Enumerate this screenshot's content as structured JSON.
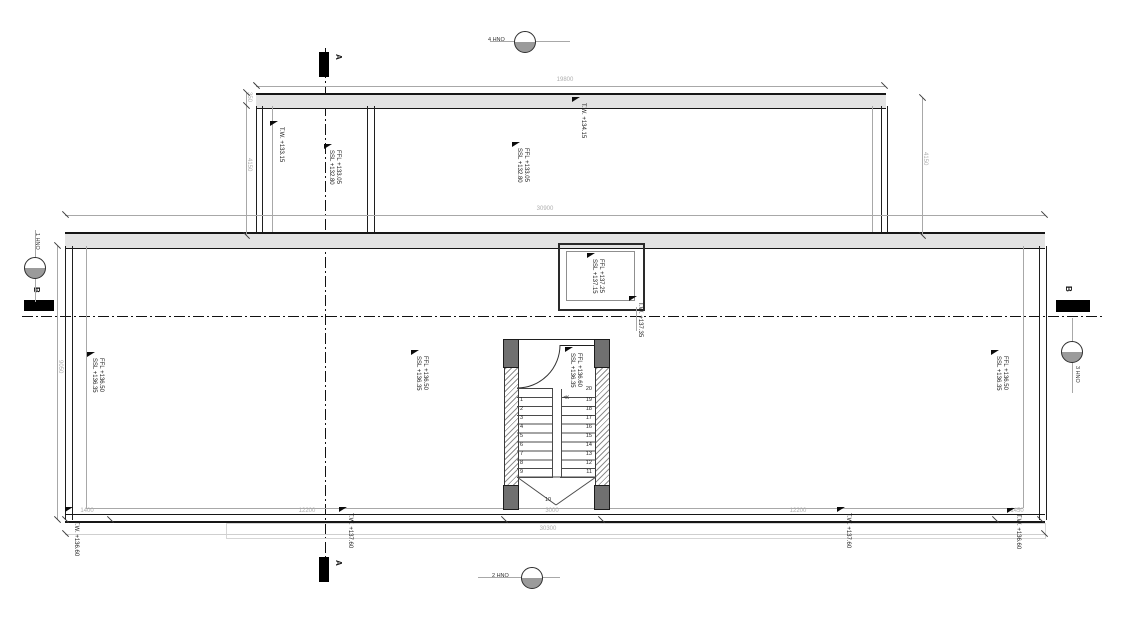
{
  "sections": {
    "a_label": "A",
    "b_label": "B"
  },
  "grid_markers": {
    "top": "4 HNO",
    "bottom": "2 HNO",
    "left": "1 HNO",
    "right": "3 HNO"
  },
  "dimensions": {
    "top_width": "19800",
    "mid_width": "30900",
    "bottom_total": "30300",
    "bottom_segments": [
      "1400",
      "12200",
      "3000",
      "12200",
      "1450"
    ],
    "upper_left_small": "350",
    "upper_left": "4150",
    "upper_right": "4150",
    "main_left": "9050"
  },
  "levels": {
    "upper_parapet_left": "T.W. +133.15",
    "upper_parapet_mid": "T.W. +134.15",
    "upper_ffl": "FFL +133.05",
    "upper_ssl": "SSL +132.80",
    "skylight_ffl": "FFL +137.25",
    "skylight_ssl": "SSL +137.15",
    "skylight_parapet": "T.W. +137.35",
    "main_ffl": "FFL +136.50",
    "main_ssl": "SSL +136.35",
    "stair_ffl": "FFL +136.60",
    "stair_ssl": "SSL +136.35",
    "parapet_corner": "T.W. +136.60",
    "parapet_inner": "T.W. +137.60"
  },
  "stair": {
    "numbers_left": [
      "1",
      "2",
      "3",
      "4",
      "5",
      "6",
      "7",
      "8",
      "9"
    ],
    "numbers_right": [
      "19",
      "18",
      "17",
      "16",
      "15",
      "14",
      "13",
      "12",
      "11"
    ],
    "top_number": "20",
    "bottom_number": "10",
    "direction_arrows": "≪"
  }
}
